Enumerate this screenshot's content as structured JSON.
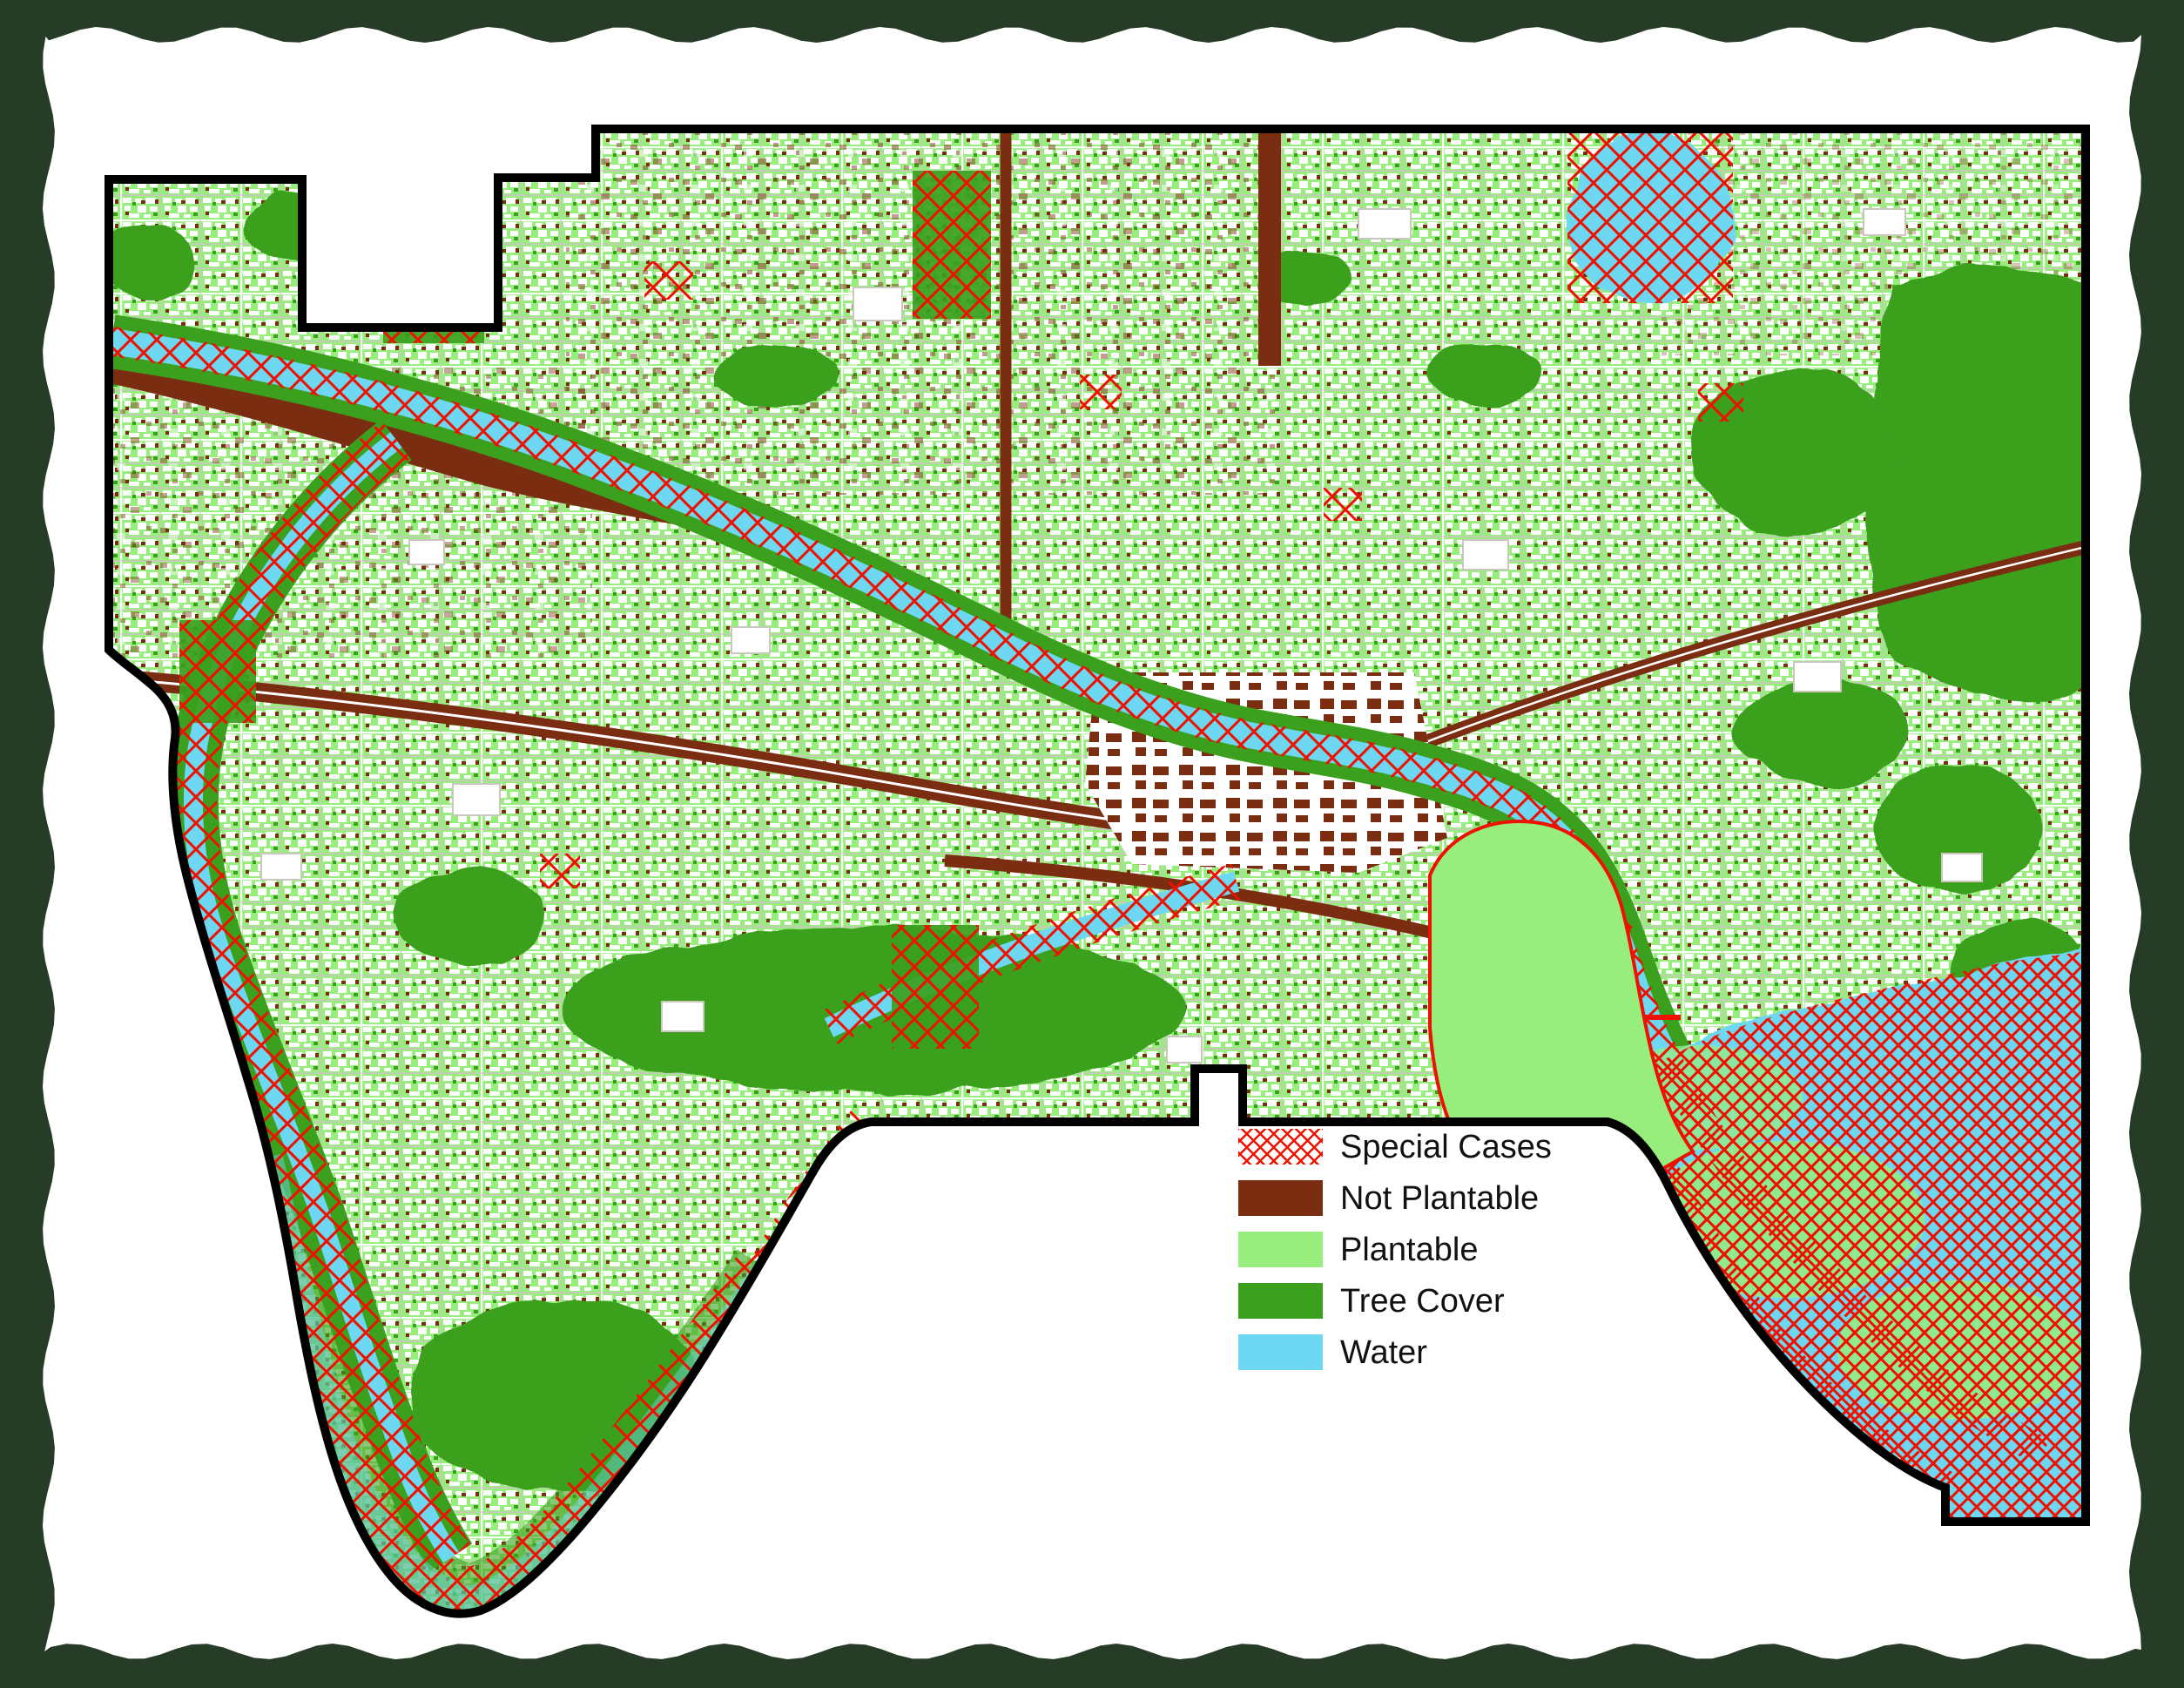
{
  "frame": {
    "color": "#273C27"
  },
  "background": "#FFFFFF",
  "colors": {
    "special_cases": "#EE1100",
    "not_plantable": "#7B2D12",
    "plantable": "#98EE7C",
    "tree_cover": "#3AA01E",
    "water": "#6ED7F2",
    "street": "#CBC7BF",
    "boundary": "#000000"
  },
  "legend": {
    "items": [
      {
        "label": "Special Cases",
        "type": "crosshatch",
        "color": "#EE1100"
      },
      {
        "label": "Not Plantable",
        "type": "solid",
        "color": "#7B2D12"
      },
      {
        "label": "Plantable",
        "type": "solid",
        "color": "#98EE7C"
      },
      {
        "label": "Tree Cover",
        "type": "solid",
        "color": "#3AA01E"
      },
      {
        "label": "Water",
        "type": "solid",
        "color": "#6ED7F2"
      }
    ]
  }
}
